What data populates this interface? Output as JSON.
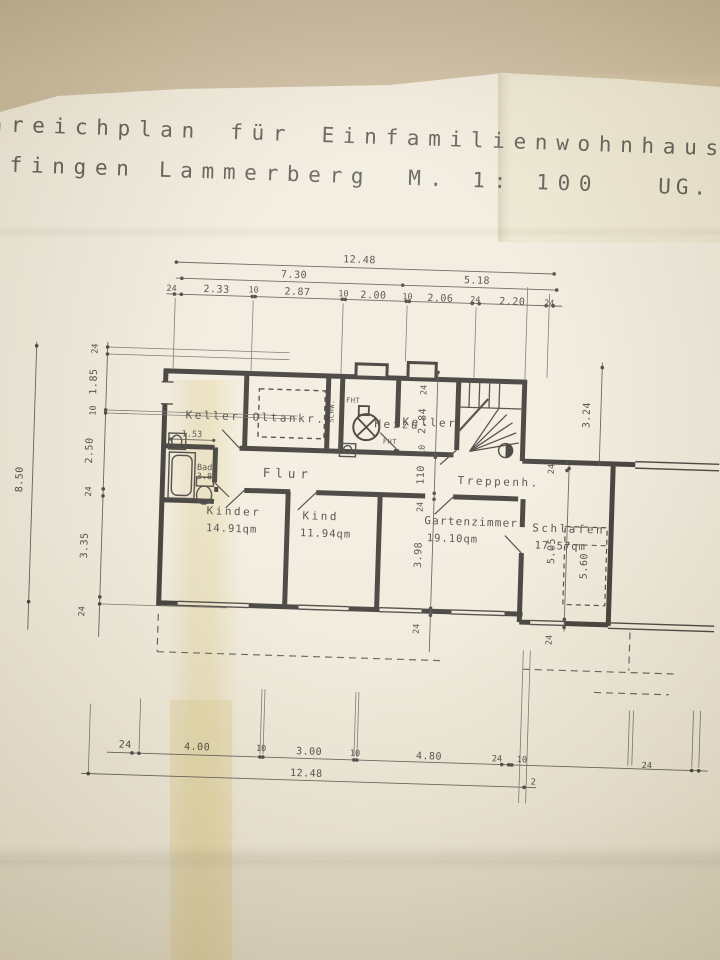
{
  "title": {
    "line1": "nreichplan für Einfamilienwohnhaus",
    "line2": "lfingen Lammerberg",
    "scale": "M. 1: 100",
    "sheet": "UG."
  },
  "rooms": [
    {
      "id": "keller-left",
      "name": "Keller",
      "area": ""
    },
    {
      "id": "oeltankraum",
      "name": "Oltankr.",
      "area": ""
    },
    {
      "id": "heizung",
      "name": "Heizu",
      "area": ""
    },
    {
      "id": "keller-right",
      "name": "Keller",
      "area": ""
    },
    {
      "id": "treppenhaus",
      "name": "Treppenh.",
      "area": ""
    },
    {
      "id": "flur",
      "name": "Flur",
      "area": ""
    },
    {
      "id": "bad",
      "name": "Bad",
      "area": "3.83"
    },
    {
      "id": "kinder",
      "name": "Kinder",
      "area": "14.91qm"
    },
    {
      "id": "kind",
      "name": "Kind",
      "area": "11.94qm"
    },
    {
      "id": "gartenzimmer",
      "name": "Gartenzimmer",
      "area": "19.10qm"
    },
    {
      "id": "schlafen",
      "name": "Schlafen",
      "area": "17.57qm"
    }
  ],
  "annotations": {
    "schw": "SCHW.",
    "fht_boiler": "FHT",
    "fht_door": "FHT"
  },
  "dims": {
    "top_total": "12.48",
    "top_left": "7.30",
    "top_right": "5.18",
    "top_chain": [
      "24",
      "2.33",
      "10",
      "2.87",
      "10",
      "2.00",
      "10",
      "2.06",
      "24",
      "2.20",
      "24"
    ],
    "left_total": "8.50",
    "left_chain": [
      "24",
      "1.85",
      "10",
      "2.50",
      "24",
      "3.35",
      "24"
    ],
    "center_chain": [
      "24",
      "2.84",
      "10",
      "110",
      "24",
      "3.98",
      "24"
    ],
    "right_upper": "3.24",
    "right_wall": "24",
    "right_room": "5.05",
    "bed_width": "5.60",
    "right_lower": "24",
    "bath": "1.53",
    "bottom_chain": [
      "24",
      "4.00",
      "10",
      "3.00",
      "10",
      "4.80",
      "24",
      "10",
      "24"
    ],
    "bottom_total": "12.48",
    "bottom_extra": "2"
  }
}
